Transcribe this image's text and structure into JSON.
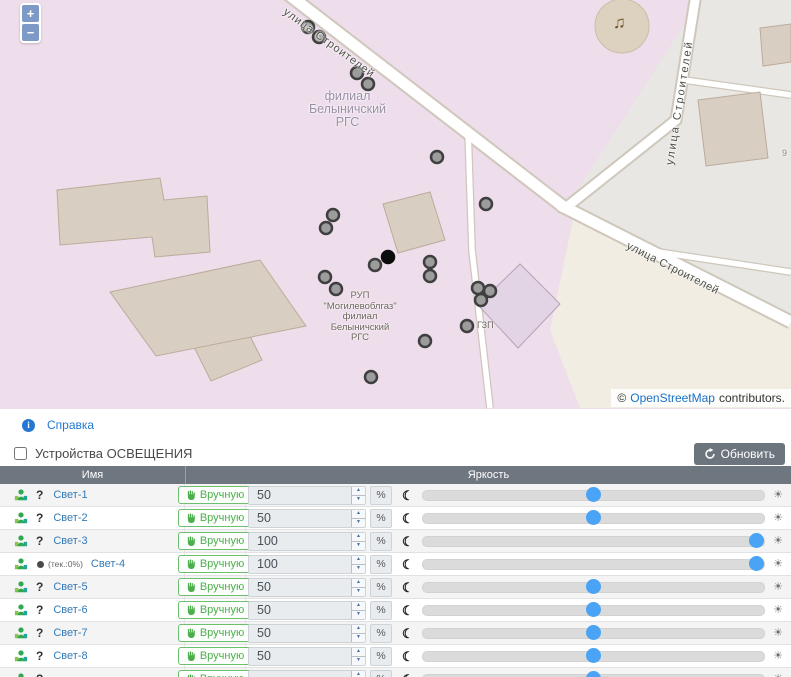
{
  "map": {
    "zoom_in": "+",
    "zoom_out": "−",
    "street_labels": [
      {
        "text": "улица Строителей"
      },
      {
        "text": "улица Строителей"
      },
      {
        "text": "улица Строителей"
      }
    ],
    "branch_label": {
      "line1": "филиал",
      "line2": "Белыничский",
      "line3": "РГС"
    },
    "rup_label": {
      "line1": "РУП",
      "line2": "\"Могилевоблгаз\"",
      "line3": "филиал",
      "line4": "Белыничский",
      "line5": "РГС"
    },
    "gzp_label": "ГЗП",
    "house_number": "9",
    "music_note": "♫",
    "attribution": {
      "copyright": "©",
      "link": "OpenStreetMap",
      "suffix": "contributors."
    },
    "markers": [
      {
        "x": 308,
        "y": 27,
        "color": "gray"
      },
      {
        "x": 319,
        "y": 37,
        "color": "gray"
      },
      {
        "x": 357,
        "y": 73,
        "color": "gray"
      },
      {
        "x": 368,
        "y": 84,
        "color": "gray"
      },
      {
        "x": 437,
        "y": 157,
        "color": "gray"
      },
      {
        "x": 486,
        "y": 204,
        "color": "gray"
      },
      {
        "x": 333,
        "y": 215,
        "color": "gray"
      },
      {
        "x": 326,
        "y": 228,
        "color": "gray"
      },
      {
        "x": 325,
        "y": 277,
        "color": "gray"
      },
      {
        "x": 336,
        "y": 289,
        "color": "gray"
      },
      {
        "x": 375,
        "y": 265,
        "color": "gray"
      },
      {
        "x": 388,
        "y": 257,
        "color": "black"
      },
      {
        "x": 430,
        "y": 262,
        "color": "gray"
      },
      {
        "x": 430,
        "y": 276,
        "color": "gray"
      },
      {
        "x": 478,
        "y": 288,
        "color": "gray"
      },
      {
        "x": 490,
        "y": 291,
        "color": "gray"
      },
      {
        "x": 481,
        "y": 300,
        "color": "gray"
      },
      {
        "x": 467,
        "y": 326,
        "color": "gray"
      },
      {
        "x": 425,
        "y": 341,
        "color": "gray"
      },
      {
        "x": 371,
        "y": 377,
        "color": "gray"
      }
    ]
  },
  "help": {
    "label": "Справка"
  },
  "panel": {
    "title": "Устройства ОСВЕЩЕНИЯ",
    "refresh": "Обновить"
  },
  "table": {
    "columns": {
      "name": "Имя",
      "brightness": "Яркость"
    },
    "manual_label": "Вручную",
    "percent_sign": "%",
    "question_glyph": "?",
    "devices": [
      {
        "name": "Свет-1",
        "value": "50",
        "percent": 50,
        "note": ""
      },
      {
        "name": "Свет-2",
        "value": "50",
        "percent": 50,
        "note": ""
      },
      {
        "name": "Свет-3",
        "value": "100",
        "percent": 100,
        "note": ""
      },
      {
        "name": "Свет-4",
        "value": "100",
        "percent": 100,
        "note": "(тек.:0%)"
      },
      {
        "name": "Свет-5",
        "value": "50",
        "percent": 50,
        "note": ""
      },
      {
        "name": "Свет-6",
        "value": "50",
        "percent": 50,
        "note": ""
      },
      {
        "name": "Свет-7",
        "value": "50",
        "percent": 50,
        "note": ""
      },
      {
        "name": "Свет-8",
        "value": "50",
        "percent": 50,
        "note": ""
      },
      {
        "name": "",
        "value": "",
        "percent": 50,
        "note": ""
      }
    ]
  },
  "colors": {
    "link": "#337ab7",
    "manual_green": "#4cae4c",
    "table_header_gray": "#6e7680",
    "slider_handle_blue": "#4aa3f5",
    "marker_gray": "#9c9c9c",
    "marker_black": "#0c0c0c"
  }
}
